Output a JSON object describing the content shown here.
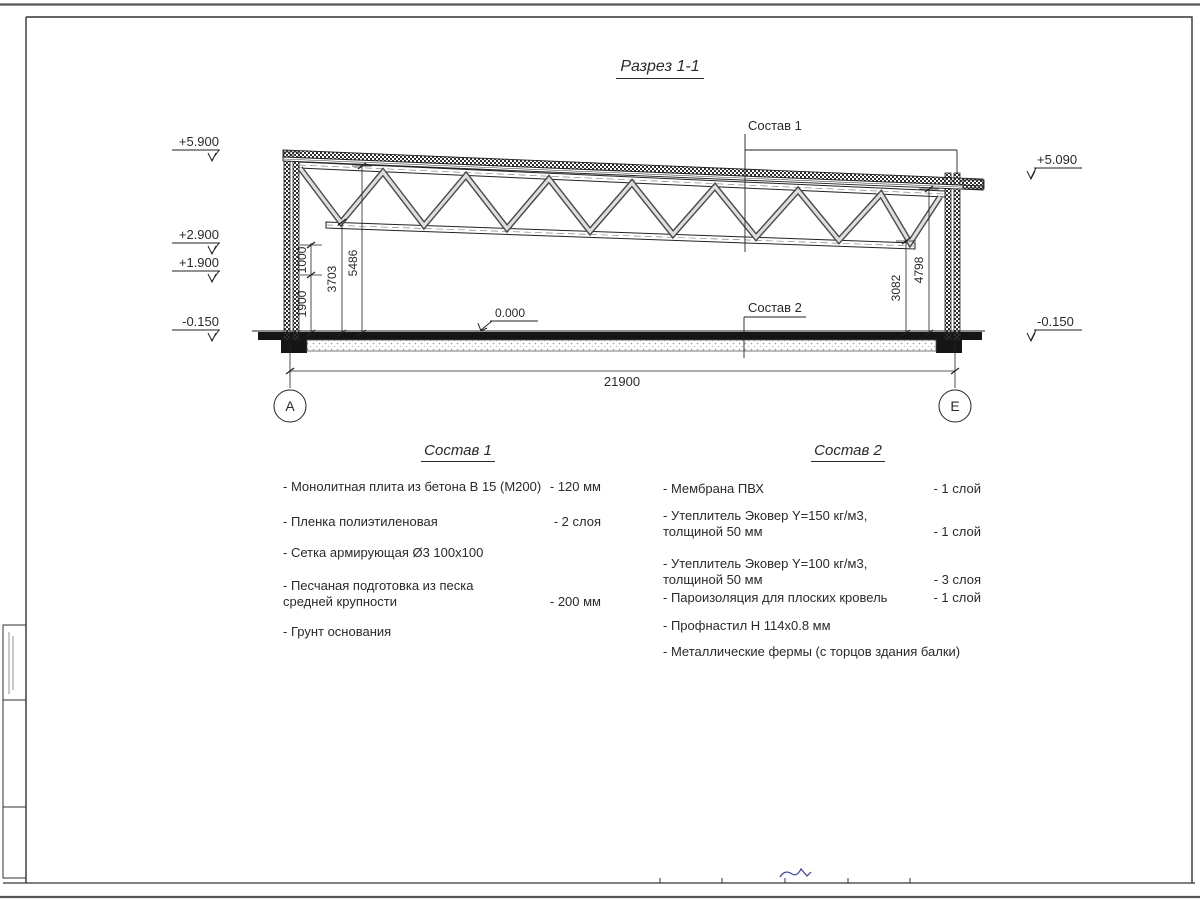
{
  "drawing": {
    "title": "Разрез 1-1",
    "callout_1": "Состав 1",
    "callout_2": "Состав 2",
    "elev_left_top": "+5.900",
    "elev_left_2900": "+2.900",
    "elev_left_1900": "+1.900",
    "elev_left_bottom": "-0.150",
    "elev_right_top": "+5.090",
    "elev_right_bottom": "-0.150",
    "elev_zero": "0.000",
    "dim_1900": "1900",
    "dim_1000": "1000",
    "dim_3703": "3703",
    "dim_5486": "5486",
    "dim_3082": "3082",
    "dim_4798": "4798",
    "dim_total": "21900",
    "axis_left": "А",
    "axis_right": "Е"
  },
  "composition1": {
    "heading": "Состав 1",
    "items": [
      {
        "name": "- Монолитная плита из бетона В 15 (М200)",
        "qty": "- 120 мм"
      },
      {
        "name": "- Пленка полиэтиленовая",
        "qty": "- 2 слоя"
      },
      {
        "name": "- Сетка армирующая Ø3 100х100",
        "qty": ""
      },
      {
        "name": "- Песчаная подготовка из песка\nсредней крупности",
        "qty": "- 200 мм"
      },
      {
        "name": "- Грунт основания",
        "qty": ""
      }
    ]
  },
  "composition2": {
    "heading": "Состав 2",
    "items": [
      {
        "name": "- Мембрана ПВХ",
        "qty": "- 1 слой"
      },
      {
        "name": "- Утеплитель Эковер Y=150 кг/м3,\nтолщиной 50 мм",
        "qty": "- 1 слой"
      },
      {
        "name": "- Утеплитель Эковер Y=100 кг/м3,\nтолщиной 50 мм",
        "qty": "- 3 слоя"
      },
      {
        "name": "- Пароизоляция для плоских кровель",
        "qty": "- 1 слой"
      },
      {
        "name": "- Профнастил Н 114х0.8 мм",
        "qty": ""
      },
      {
        "name": "- Металлические фермы (с торцов здания балки)",
        "qty": ""
      }
    ]
  }
}
